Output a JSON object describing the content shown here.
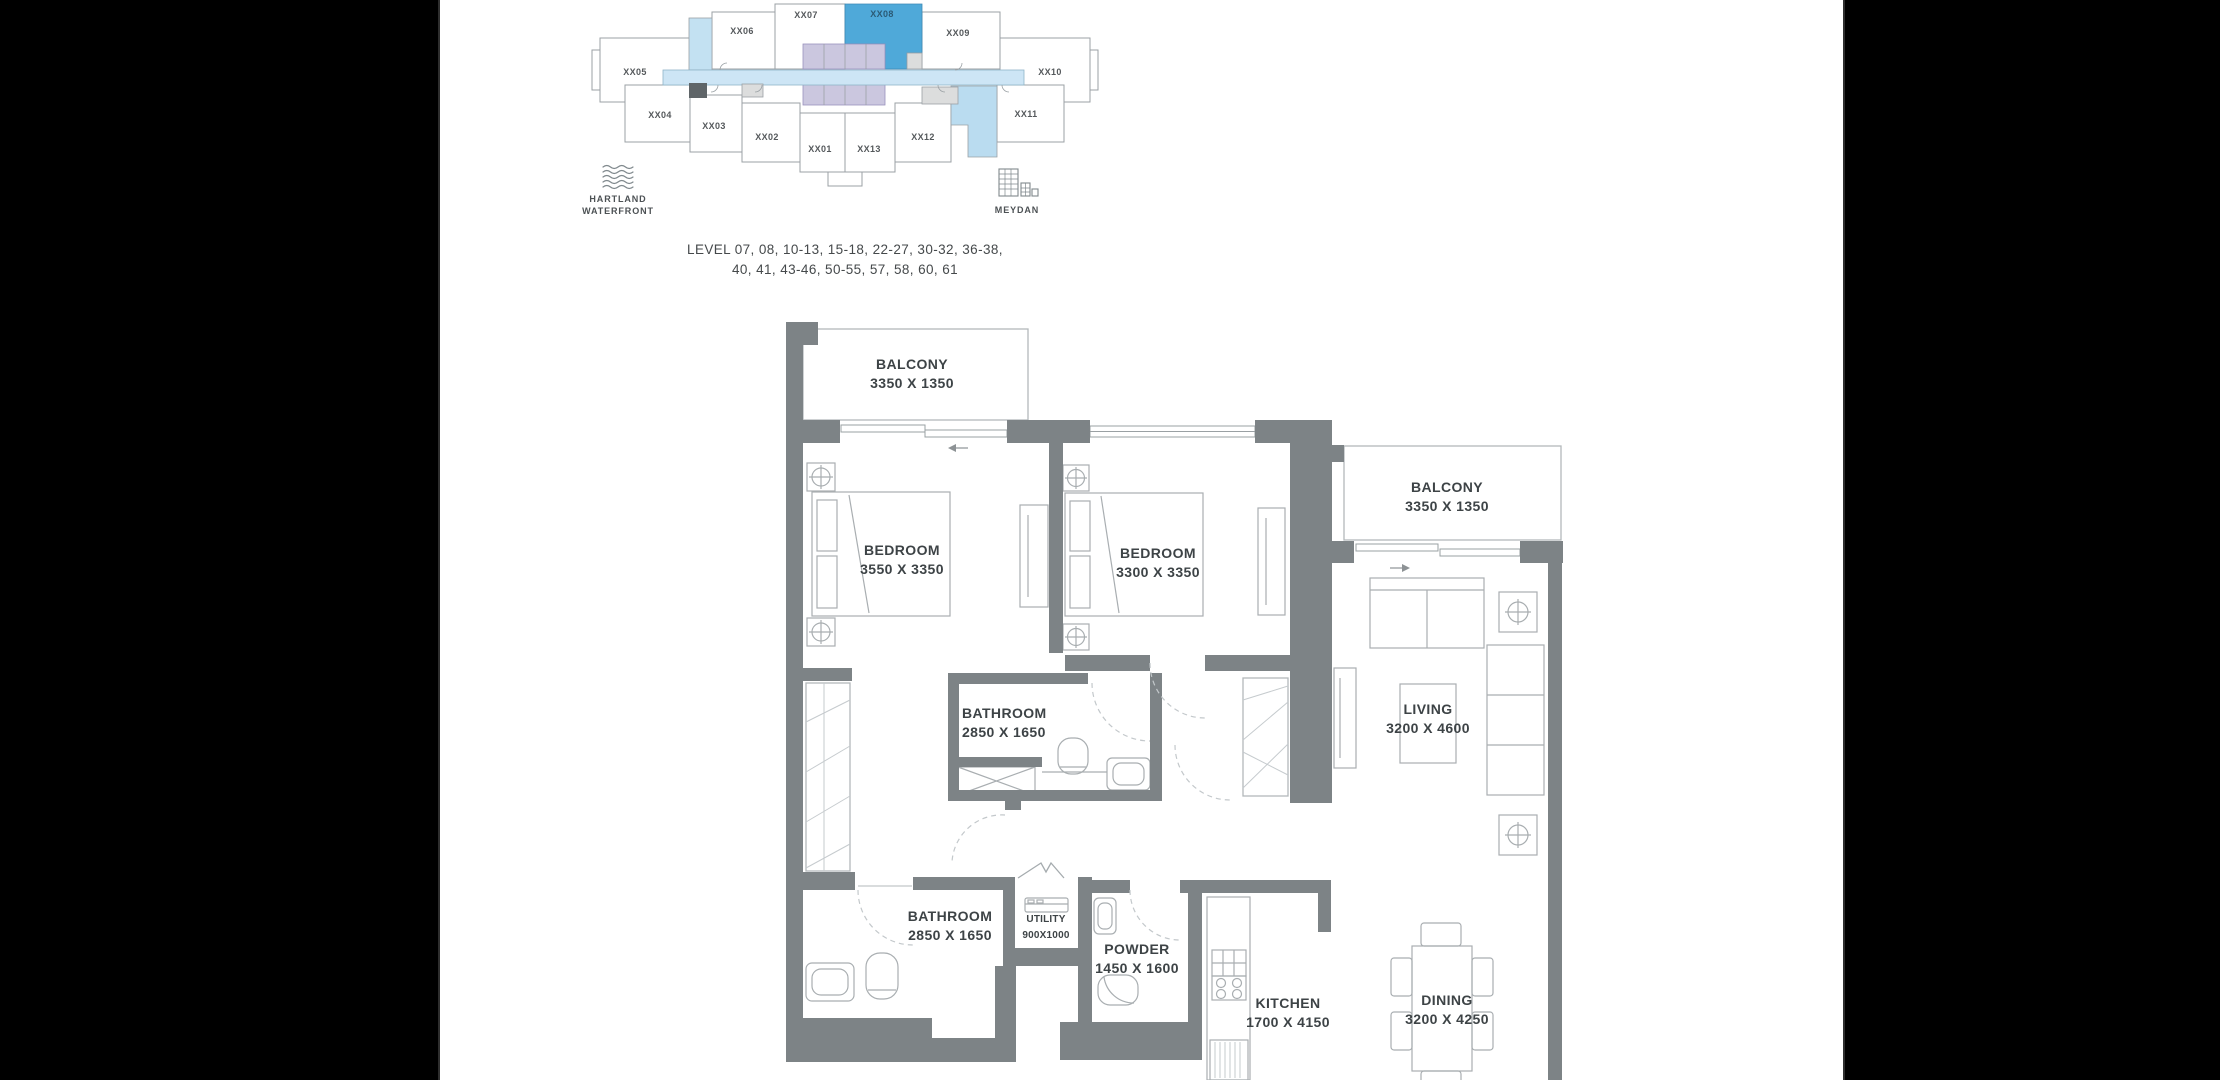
{
  "colors": {
    "highlight_blue": "#4FA9D9",
    "corridor_blue": "#CDE5F5",
    "light_blue_unit": "#BADCF0",
    "core_lavender": "#CBC7DF",
    "wall_gray": "#7D8386",
    "page_black": "#000000",
    "canvas_white": "#FFFFFF",
    "label_gray": "#3D4346"
  },
  "key_plan": {
    "highlighted_unit": "XX08",
    "units": [
      {
        "label": "XX05"
      },
      {
        "label": "XX06"
      },
      {
        "label": "XX07"
      },
      {
        "label": "XX08"
      },
      {
        "label": "XX09"
      },
      {
        "label": "XX10"
      },
      {
        "label": "XX04"
      },
      {
        "label": "XX03"
      },
      {
        "label": "XX02"
      },
      {
        "label": "XX01"
      },
      {
        "label": "XX13"
      },
      {
        "label": "XX12"
      },
      {
        "label": "XX11"
      }
    ],
    "landmark_left": {
      "line1": "HARTLAND",
      "line2": "WATERFRONT"
    },
    "landmark_right": {
      "label": "MEYDAN"
    },
    "levels": {
      "line1": "LEVEL 07, 08, 10-13, 15-18, 22-27, 30-32, 36-38,",
      "line2": "40, 41, 43-46, 50-55, 57, 58, 60, 61"
    }
  },
  "floor_plan": {
    "rooms": {
      "balcony_top": {
        "name": "BALCONY",
        "dims": "3350 X 1350"
      },
      "bedroom_1": {
        "name": "BEDROOM",
        "dims": "3550 X 3350"
      },
      "bedroom_2": {
        "name": "BEDROOM",
        "dims": "3300 X 3350"
      },
      "balcony_right": {
        "name": "BALCONY",
        "dims": "3350 X 1350"
      },
      "living": {
        "name": "LIVING",
        "dims": "3200 X 4600"
      },
      "bathroom_1": {
        "name": "BATHROOM",
        "dims": "2850 X 1650"
      },
      "bathroom_2": {
        "name": "BATHROOM",
        "dims": "2850 X 1650"
      },
      "utility": {
        "name": "UTILITY",
        "dims": "900X1000"
      },
      "powder": {
        "name": "POWDER",
        "dims": "1450 X 1600"
      },
      "kitchen": {
        "name": "KITCHEN",
        "dims": "1700 X 4150"
      },
      "dining": {
        "name": "DINING",
        "dims": "3200 X 4250"
      }
    }
  }
}
